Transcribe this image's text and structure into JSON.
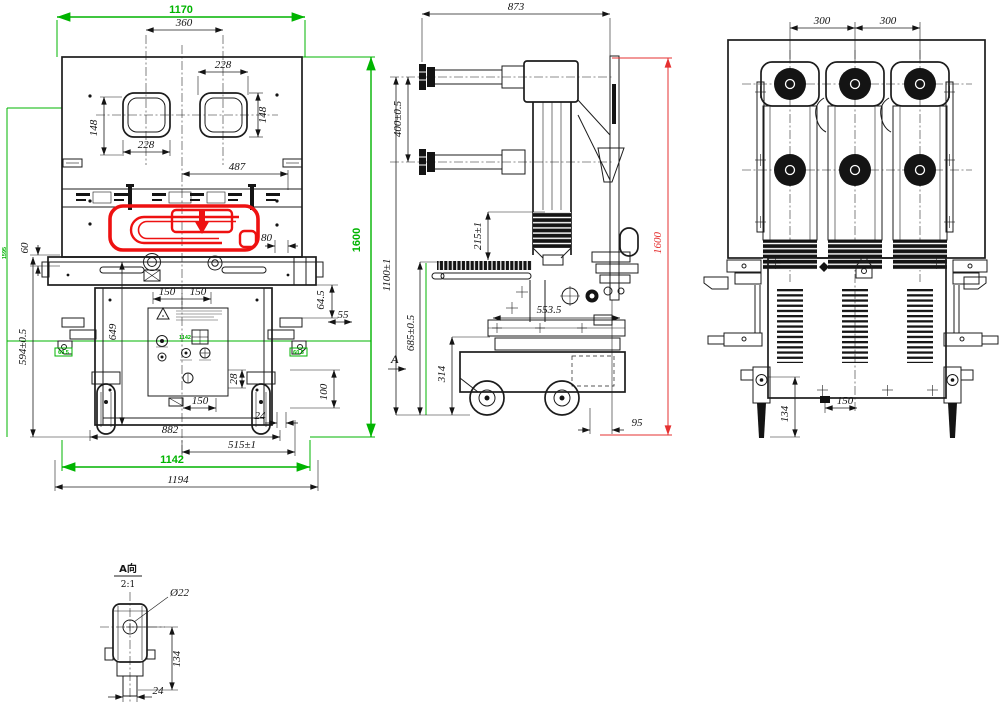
{
  "palette": {
    "line": "#1c1c1c",
    "green": "#00b400",
    "red": "#e53030",
    "highlight_red": "#ee1111",
    "background": "#ffffff"
  },
  "front_view": {
    "dims": {
      "overall_width_green": "1170",
      "handle_pitch": "360",
      "hole_width_right": "228",
      "hole_height_right": "148",
      "hole_height_left": "148",
      "hole_width_left": "228",
      "offset_487": "487",
      "height_green": "1600",
      "offset_60": "60",
      "height_594": "594±0.5",
      "height_649": "649",
      "pitch_150_left": "150",
      "pitch_150_right": "150",
      "offset_80": "80",
      "offset_64_5": "64.5",
      "offset_55": "55",
      "offset_28": "28",
      "wheel_height_100": "100",
      "base_150": "150",
      "offset_24": "24",
      "wheel_span_882": "882",
      "span_515": "515±1",
      "width_green_1142": "1142",
      "overall_width_1194": "1194",
      "tag_left_green": "1595",
      "tag_center_green": "1142",
      "tag_wheel_left": "60.5",
      "tag_wheel_right": "60.5"
    }
  },
  "side_view": {
    "dims": {
      "depth_873": "873",
      "pole_pitch_400": "400±0.5",
      "offset_215": "215±1",
      "height_1100": "1100±1",
      "height_685": "685±0.5",
      "height_314": "314",
      "depth_553_5": "553.5",
      "offset_95": "95",
      "height_red_1600": "1600",
      "view_arrow": "A"
    }
  },
  "rear_view": {
    "dims": {
      "pole_pitch_left": "300",
      "pole_pitch_right": "300",
      "base_150": "150",
      "bracket_134": "134"
    }
  },
  "detail_view": {
    "title": "A向",
    "scale": "2:1",
    "dims": {
      "hole_dia": "Ø22",
      "height_134": "134",
      "width_24": "24"
    }
  }
}
